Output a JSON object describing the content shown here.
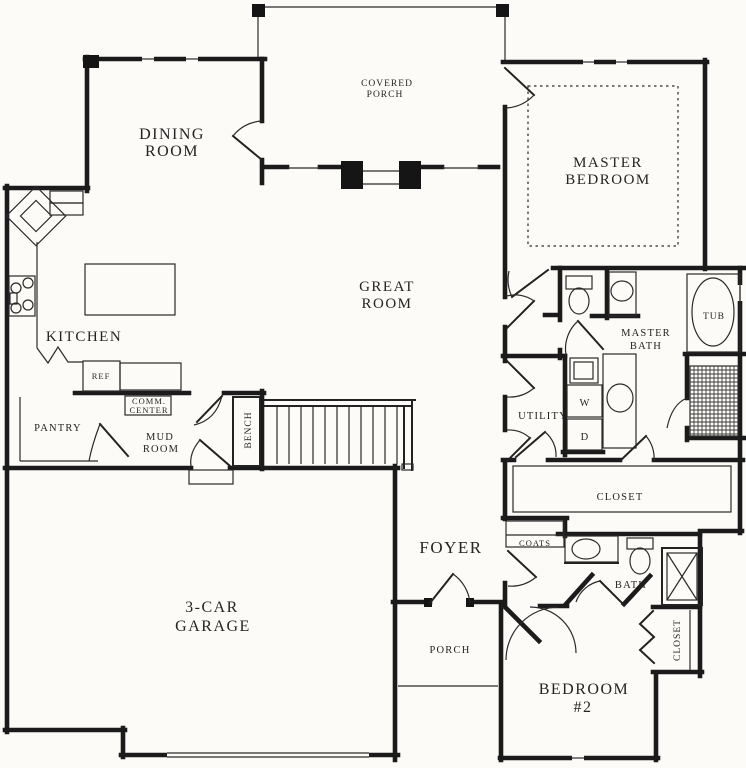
{
  "canvas": {
    "width": 746,
    "height": 768,
    "paper_color": "#fcfbf8",
    "ink_color": "#1b1b1b"
  },
  "rooms": {
    "covered_porch": {
      "l1": "COVERED",
      "l2": "PORCH"
    },
    "dining_room": {
      "l1": "DINING",
      "l2": "ROOM"
    },
    "master_bedroom": {
      "l1": "MASTER",
      "l2": "BEDROOM"
    },
    "great_room": {
      "l1": "GREAT",
      "l2": "ROOM"
    },
    "kitchen": {
      "l1": "KITCHEN"
    },
    "pantry": {
      "l1": "PANTRY"
    },
    "mud_room": {
      "l1": "MUD",
      "l2": "ROOM"
    },
    "comm_center": {
      "l1": "COMM.",
      "l2": "CENTER"
    },
    "utility": {
      "l1": "UTILITY"
    },
    "master_bath": {
      "l1": "MASTER",
      "l2": "BATH"
    },
    "master_closet": {
      "l1": "CLOSET"
    },
    "foyer": {
      "l1": "FOYER"
    },
    "coats": {
      "l1": "COATS"
    },
    "bath": {
      "l1": "BATH"
    },
    "garage": {
      "l1": "3-CAR",
      "l2": "GARAGE"
    },
    "porch": {
      "l1": "PORCH"
    },
    "bedroom_2": {
      "l1": "BEDROOM",
      "l2": "#2"
    },
    "bedroom_2_closet": {
      "l1": "CLOSET"
    }
  },
  "fixtures": {
    "bench": "BENCH",
    "ref": "REF",
    "tub": "TUB",
    "washer": "W",
    "dryer": "D"
  }
}
